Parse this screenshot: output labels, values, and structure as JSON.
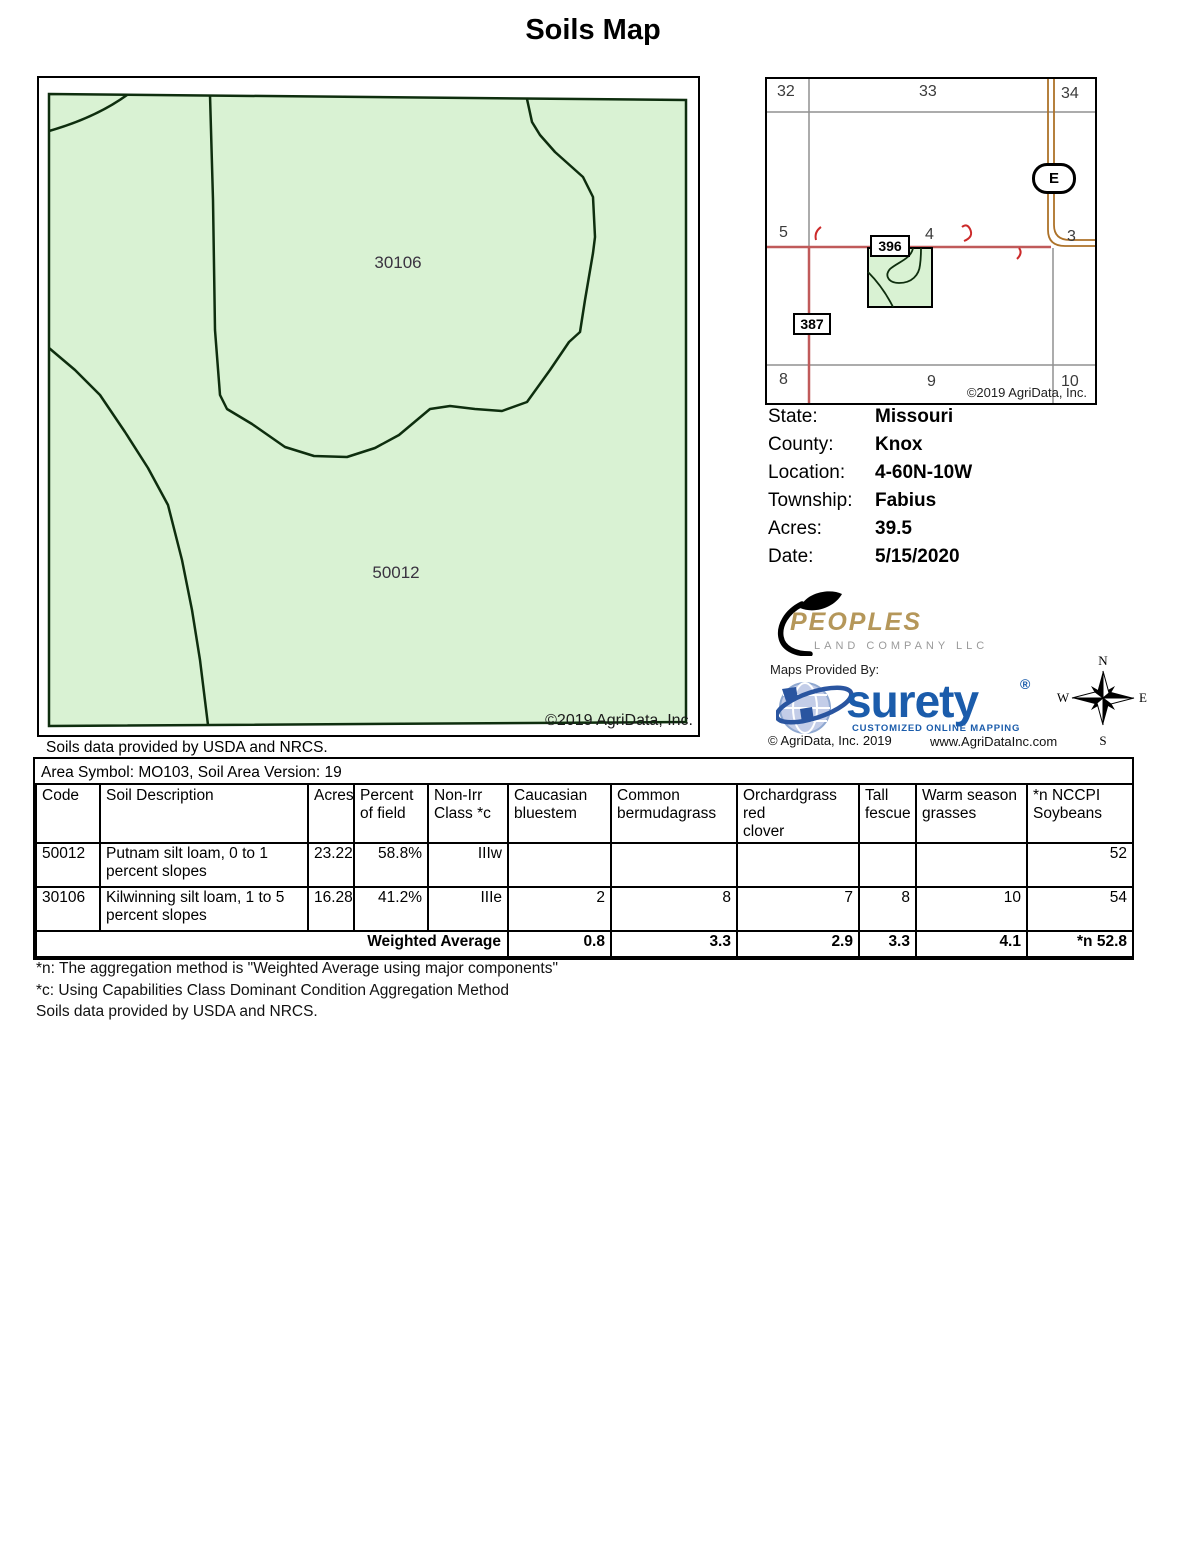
{
  "title": "Soils Map",
  "map": {
    "region_labels": [
      "30106",
      "50012"
    ],
    "copyright": "©2019 AgriData, Inc.",
    "caption": "Soils data provided by USDA and NRCS."
  },
  "inset": {
    "sections": [
      "32",
      "33",
      "34",
      "5",
      "4",
      "3",
      "8",
      "9",
      "10"
    ],
    "routes": {
      "r396": "396",
      "r387": "387",
      "rE": "E"
    },
    "copyright": "©2019 AgriData, Inc."
  },
  "info": {
    "rows": [
      {
        "label": "State:",
        "value": "Missouri"
      },
      {
        "label": "County:",
        "value": "Knox"
      },
      {
        "label": "Location:",
        "value": "4-60N-10W"
      },
      {
        "label": "Township:",
        "value": "Fabius"
      },
      {
        "label": "Acres:",
        "value": "39.5"
      },
      {
        "label": "Date:",
        "value": "5/15/2020"
      }
    ]
  },
  "branding": {
    "peoples_name": "PEOPLES",
    "peoples_sub": "LAND COMPANY LLC",
    "maps_provided_by": "Maps Provided By:",
    "surety_name": "surety",
    "surety_reg": "®",
    "surety_tagline": "CUSTOMIZED ONLINE MAPPING",
    "agridata_copyright": "© AgriData, Inc. 2019",
    "agridata_url": "www.AgriDataInc.com"
  },
  "compass": {
    "n": "N",
    "e": "E",
    "s": "S",
    "w": "W"
  },
  "soil_table": {
    "area_symbol": "Area Symbol: MO103, Soil Area Version: 19",
    "headers": [
      "Code",
      "Soil Description",
      "Acres",
      "Percent\nof field",
      "Non-Irr\nClass *c",
      "Caucasian\nbluestem",
      "Common\nbermudagrass",
      "Orchardgrass red\nclover",
      "Tall\nfescue",
      "Warm season\ngrasses",
      "*n NCCPI\nSoybeans"
    ],
    "rows": [
      {
        "cells": [
          "50012",
          "Putnam silt loam, 0 to 1 percent slopes",
          "23.22",
          "58.8%",
          "IIIw",
          "",
          "",
          "",
          "",
          "",
          "52"
        ]
      },
      {
        "cells": [
          "30106",
          "Kilwinning silt loam, 1 to 5 percent slopes",
          "16.28",
          "41.2%",
          "IIIe",
          "2",
          "8",
          "7",
          "8",
          "10",
          "54"
        ]
      }
    ],
    "weighted_average": {
      "label": "Weighted Average",
      "values": [
        "0.8",
        "3.3",
        "2.9",
        "3.3",
        "4.1",
        "*n 52.8"
      ]
    }
  },
  "footnotes": [
    "*n: The aggregation method is \"Weighted Average using major components\"",
    "*c: Using Capabilities Class Dominant Condition Aggregation Method",
    "Soils data provided by USDA and NRCS."
  ],
  "colors": {
    "map_fill_green": "#d9f2d3",
    "soil_boundary": "#0e2e0e",
    "section_line_gray": "#909090",
    "road_red": "#c05a5a",
    "highway_brown": "#ad7229",
    "squiggle_red": "#cc2a2a",
    "surety_blue": "#1b5cab",
    "peoples_gold": "#b5975a"
  }
}
